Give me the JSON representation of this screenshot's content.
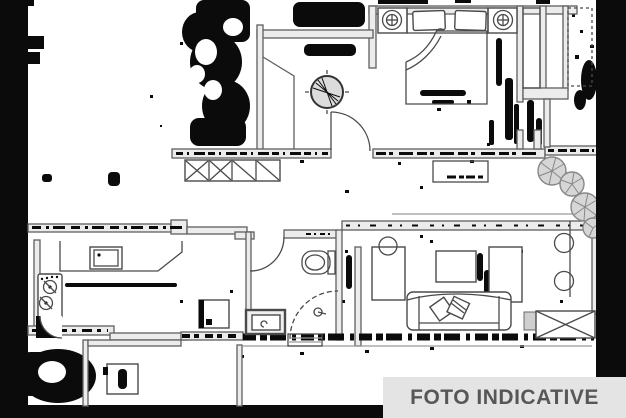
{
  "watermark": {
    "label": "FOTO INDICATIVE"
  },
  "colors": {
    "bg": "#ffffff",
    "wallStroke": "#5f5f5f",
    "wallFill": "#ececec",
    "furnStroke": "#4a4a4a",
    "noise": "#0b0b0b",
    "plantFill": "#d6d6d6",
    "plantStroke": "#878787",
    "grayLine": "#9a9a9a",
    "labelBg": "#e4e4e4",
    "labelFg": "#575757"
  },
  "floorplan": {
    "type": "apartment-floor-plan-scan",
    "rooms": [
      {
        "name": "bedroom"
      },
      {
        "name": "entry-hall"
      },
      {
        "name": "wardrobe-corridor"
      },
      {
        "name": "bathroom"
      },
      {
        "name": "kitchen"
      },
      {
        "name": "living-room"
      },
      {
        "name": "service-balcony"
      },
      {
        "name": "terrace"
      }
    ],
    "objects": [
      "double-bed",
      "pillow",
      "pillow",
      "nightstand-lamp",
      "nightstand-lamp",
      "closet-4-sections",
      "round-hall-table",
      "entry-door-arc",
      "bathroom-door-arc",
      "toilet",
      "shower-corner",
      "wash-basin",
      "door-threshold",
      "kitchen-counter",
      "kitchen-sink",
      "cooktop-2-burners",
      "corner-unit",
      "fridge",
      "washing-machine",
      "sofa",
      "throw-pillow",
      "throw-pillow",
      "coffee-table",
      "tv-cabinet",
      "side-unit",
      "side-chair-circle",
      "stool-circle",
      "stool-circle",
      "hall-console",
      "window-x-box",
      "plant",
      "plant",
      "plant",
      "plant"
    ],
    "closet_sections": 4,
    "plants_count": 4
  }
}
